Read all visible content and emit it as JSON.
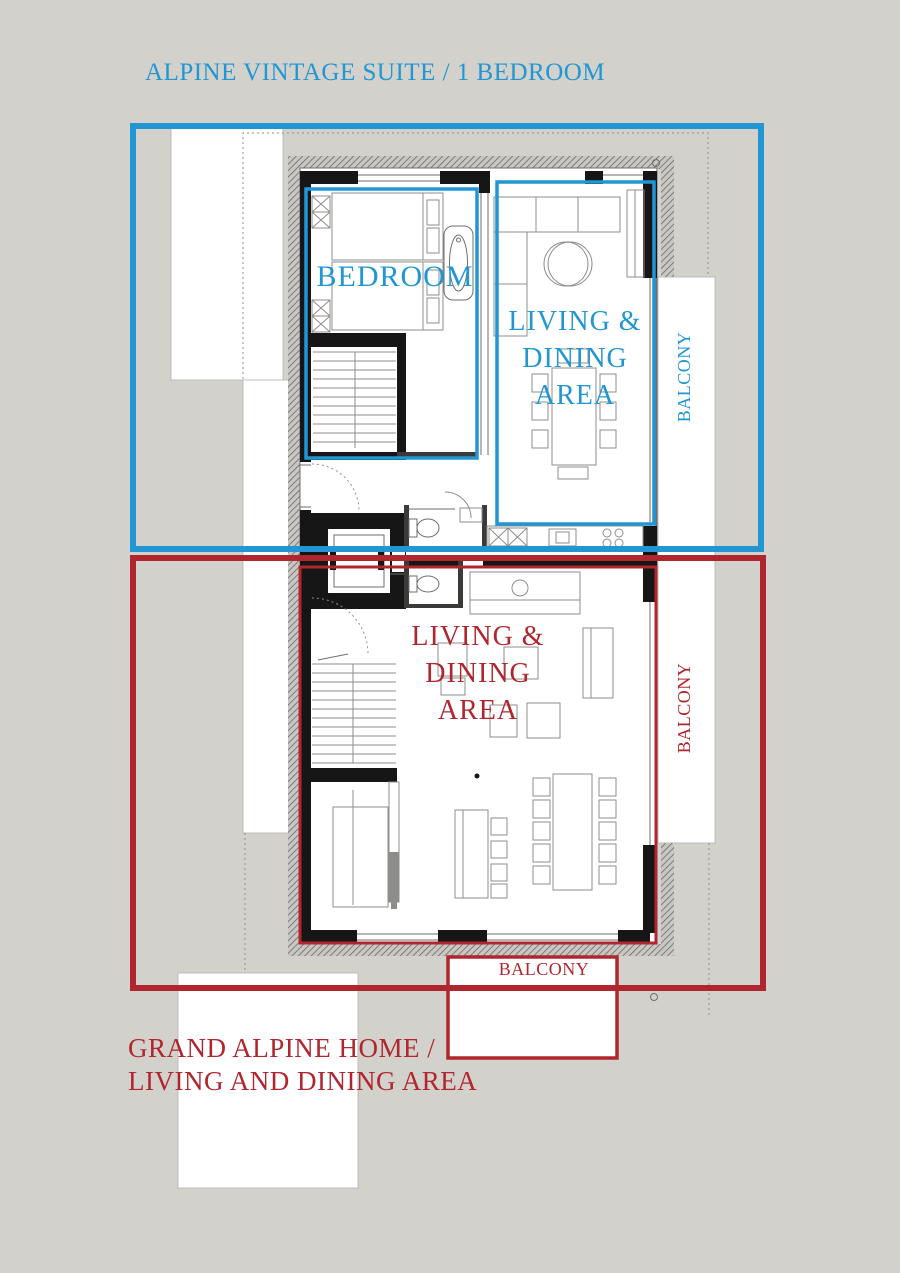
{
  "colors": {
    "accent_blue": "#2196d3",
    "accent_red": "#b0262e",
    "background": "#d2d1cc"
  },
  "annotations": {
    "title": "ALPINE VINTAGE SUITE / 1 BEDROOM",
    "caption_lines": [
      "GRAND ALPINE HOME /",
      "LIVING AND DINING AREA"
    ]
  },
  "zones": {
    "suite": {
      "bedroom_label": "BEDROOM",
      "living_lines": [
        "LIVING &",
        "DINING",
        "AREA"
      ],
      "balcony_label": "BALCONY"
    },
    "home": {
      "living_lines": [
        "LIVING &",
        "DINING",
        "AREA"
      ],
      "balcony_side_label": "BALCONY",
      "balcony_bottom_label": "BALCONY"
    }
  }
}
